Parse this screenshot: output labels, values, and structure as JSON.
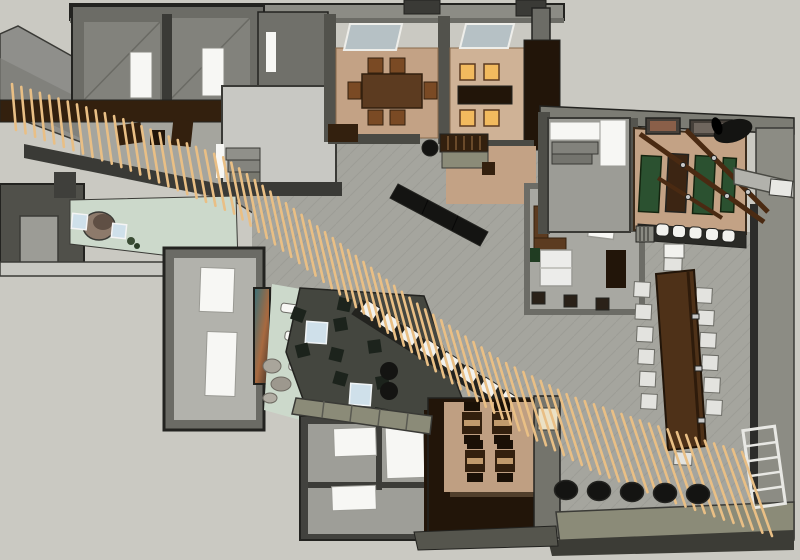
{
  "meta": {
    "title": "3D overhead floor-plan rendering of a restaurant interior",
    "width": 800,
    "height": 560,
    "style": "SketchUp-like cutaway top view, no visible text"
  },
  "palette": {
    "bg": "#cac9c2",
    "wallTop": "#8c8c85",
    "wallMid": "#6c6c66",
    "wallDark": "#3a3a36",
    "ink": "#232320",
    "tile": "#a5a59e",
    "tileDark": "#8f8f88",
    "roof": "#8f8f8b",
    "roofDark": "#7a7a76",
    "brick": "#c3a285",
    "brickLight": "#cfb296",
    "mint": "#ccd9cb",
    "lounge": "#44463f",
    "loungeChair": "#1c231c",
    "wood": "#5c3b20",
    "woodMid": "#7a4a24",
    "woodDark": "#33200e",
    "espresso": "#221509",
    "walnut": "#4e3118",
    "slat": "#e9bf85",
    "white": "#f7f7f4",
    "chairWhite": "#f2f2ee",
    "chairGray": "#e3e3df",
    "glass": "#cfe0ea",
    "skylight": "#b6c1c5",
    "green": "#2b5130",
    "amber": "#f2ba5e",
    "black": "#141412",
    "olive": "#8b8b78",
    "oliveDark": "#717162",
    "cream": "#ebe1c5",
    "steel": "#c9c9c9",
    "muralTeal": "#37717b",
    "muralRust": "#a86a40"
  },
  "scene": {
    "regions": [
      {
        "id": "slat-screen",
        "label": "diagonal wood-slat screen crossing the plan"
      },
      {
        "id": "top-left-rooms",
        "label": "two service rooms with white doors"
      },
      {
        "id": "kitchen",
        "label": "kitchen with step counters"
      },
      {
        "id": "private-dining-a",
        "label": "private dining room, wood table, 6 chairs, skylight"
      },
      {
        "id": "private-dining-b",
        "label": "private dining room, 4 glowing amber chairs, skylight"
      },
      {
        "id": "entry-vestibule",
        "label": "entry with curved reception desk and two glass seats"
      },
      {
        "id": "gallery-room",
        "label": "side room with white panels, mural, rocks, benches"
      },
      {
        "id": "lounge",
        "label": "dark lounge with two glass tables and black chairs"
      },
      {
        "id": "sushi-bar",
        "label": "diagonal bar with row of white chairs"
      },
      {
        "id": "waiting-bench",
        "label": "long black diagonal bench"
      },
      {
        "id": "restrooms",
        "label": "restroom block with white fixtures"
      },
      {
        "id": "tatami-room",
        "label": "sunken brick room with four booth tables"
      },
      {
        "id": "office",
        "label": "office with desk, white sofas, cabinet"
      },
      {
        "id": "communal-table",
        "label": "long walnut table with twelve white chairs"
      },
      {
        "id": "wine-bar-room",
        "label": "brick room with green benches, ceiling beams, pictures, barrel"
      },
      {
        "id": "bar-counter",
        "label": "counter with five white stools"
      },
      {
        "id": "walkways",
        "label": "olive paver walkways"
      },
      {
        "id": "stool-cylinder-row",
        "label": "row of black drum stools"
      }
    ]
  },
  "generated": {
    "slats": {
      "name": "wood-slat",
      "count": 86,
      "color": "slat",
      "width": 2.6,
      "path": [
        [
          12,
          84
        ],
        [
          120,
          118
        ],
        [
          225,
          158
        ],
        [
          330,
          236
        ],
        [
          420,
          306
        ],
        [
          500,
          360
        ],
        [
          570,
          396
        ],
        [
          650,
          424
        ],
        [
          742,
          452
        ]
      ],
      "len": [
        46,
        84
      ],
      "tilt": [
        4,
        30
      ]
    },
    "rows": [
      {
        "target": "sushi-chair-row",
        "name": "sushi-bar-chair",
        "kind": "rect",
        "count": 10,
        "start": [
          362,
          303
        ],
        "step": [
          19.8,
          12.9
        ],
        "size": [
          16,
          14
        ],
        "rot": 33,
        "fill": "chairWhite",
        "stroke": "ink",
        "sw": 1
      },
      {
        "target": "communal-chairs-left",
        "name": "dining-chair",
        "kind": "rect",
        "count": 6,
        "start": [
          634,
          282
        ],
        "step": [
          1.4,
          22.4
        ],
        "size": [
          16,
          15
        ],
        "rot": 3,
        "fill": "chairGray",
        "stroke": "wallMid",
        "sw": 1
      },
      {
        "target": "communal-chairs-right",
        "name": "dining-chair",
        "kind": "rect",
        "count": 6,
        "start": [
          696,
          288
        ],
        "step": [
          2.0,
          22.4
        ],
        "size": [
          16,
          15
        ],
        "rot": 3,
        "fill": "chairGray",
        "stroke": "wallMid",
        "sw": 1
      },
      {
        "target": "bar-stool-row",
        "name": "bar-stool",
        "kind": "rect",
        "count": 5,
        "start": [
          656,
          224
        ],
        "step": [
          16.5,
          1.5
        ],
        "size": [
          13,
          12
        ],
        "rot": 2,
        "rx": 4,
        "fill": "chairWhite",
        "stroke": "ink",
        "sw": 1
      },
      {
        "target": "stool-cylinder-row",
        "name": "drum-stool",
        "kind": "ellipse",
        "count": 5,
        "start": [
          566,
          490
        ],
        "step": [
          33,
          1
        ],
        "size": [
          23,
          19
        ],
        "fill": "black",
        "stroke": "ink",
        "sw": 1.5
      }
    ]
  }
}
